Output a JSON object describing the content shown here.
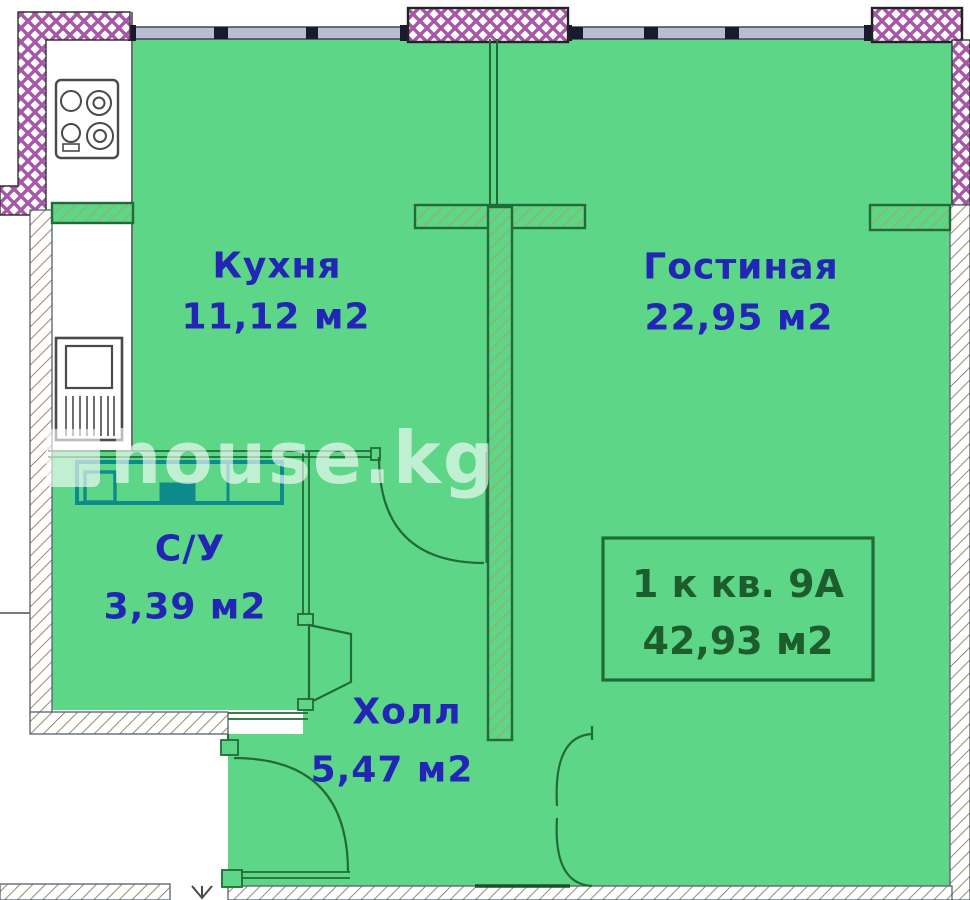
{
  "meta": {
    "type": "apartment-floor-plan"
  },
  "watermark": {
    "text": "house.kg"
  },
  "unit_info": {
    "label": "1 к кв. 9А",
    "total_area": "42,93 м2"
  },
  "rooms": [
    {
      "key": "kitchen",
      "name": "Кухня",
      "area": "11,12 м2"
    },
    {
      "key": "living-room",
      "name": "Гостиная",
      "area": "22,95 м2"
    },
    {
      "key": "bathroom",
      "name": "С/У",
      "area": "3,39 м2"
    },
    {
      "key": "hall",
      "name": "Холл",
      "area": "5,47 м2"
    }
  ],
  "icons": {
    "stove": "stove-icon",
    "fridge": "fridge-icon",
    "sanitary": "bathroom-fixtures-icon"
  },
  "colors": {
    "room_fill": "#5ed687",
    "wall_line": "#206b37",
    "label_text": "#2326b4",
    "unit_text": "#1d5c2c",
    "exterior_wall_hatch": "#a757a7",
    "window_fill": "#b9bdd1",
    "fixture_teal": "#0d8b8b",
    "hatch_line": "#9b8f73",
    "frame_black": "#222222",
    "watermark_white": "#ffffff"
  }
}
